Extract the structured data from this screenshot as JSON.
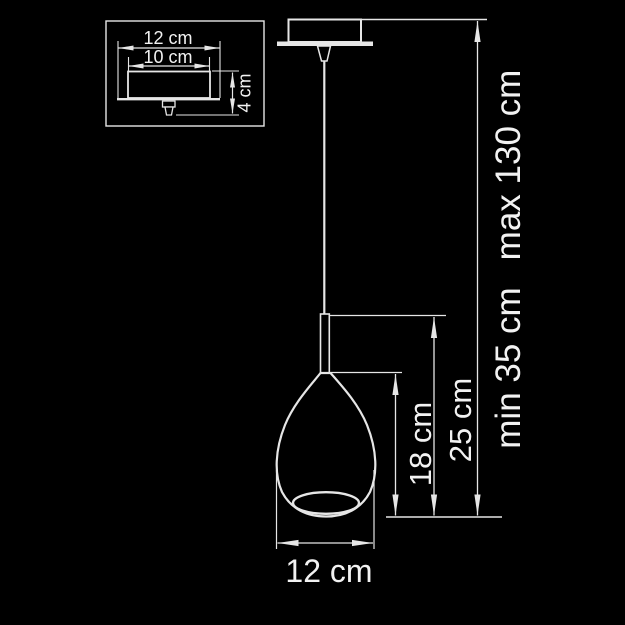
{
  "canvas": {
    "background": "#000000",
    "line_color": "#e6e6e6",
    "text_color": "#f2f2f2"
  },
  "inset": {
    "canopy_width_label": "12 cm",
    "canopy_inner_width_label": "10 cm",
    "canopy_height_label": "4 cm"
  },
  "main": {
    "shade_height_label": "18 cm",
    "lamp_body_height_label": "25 cm",
    "suspension_min_label": "min 35 cm",
    "suspension_max_label": "max 130 cm",
    "shade_diameter_label": "12 cm"
  }
}
